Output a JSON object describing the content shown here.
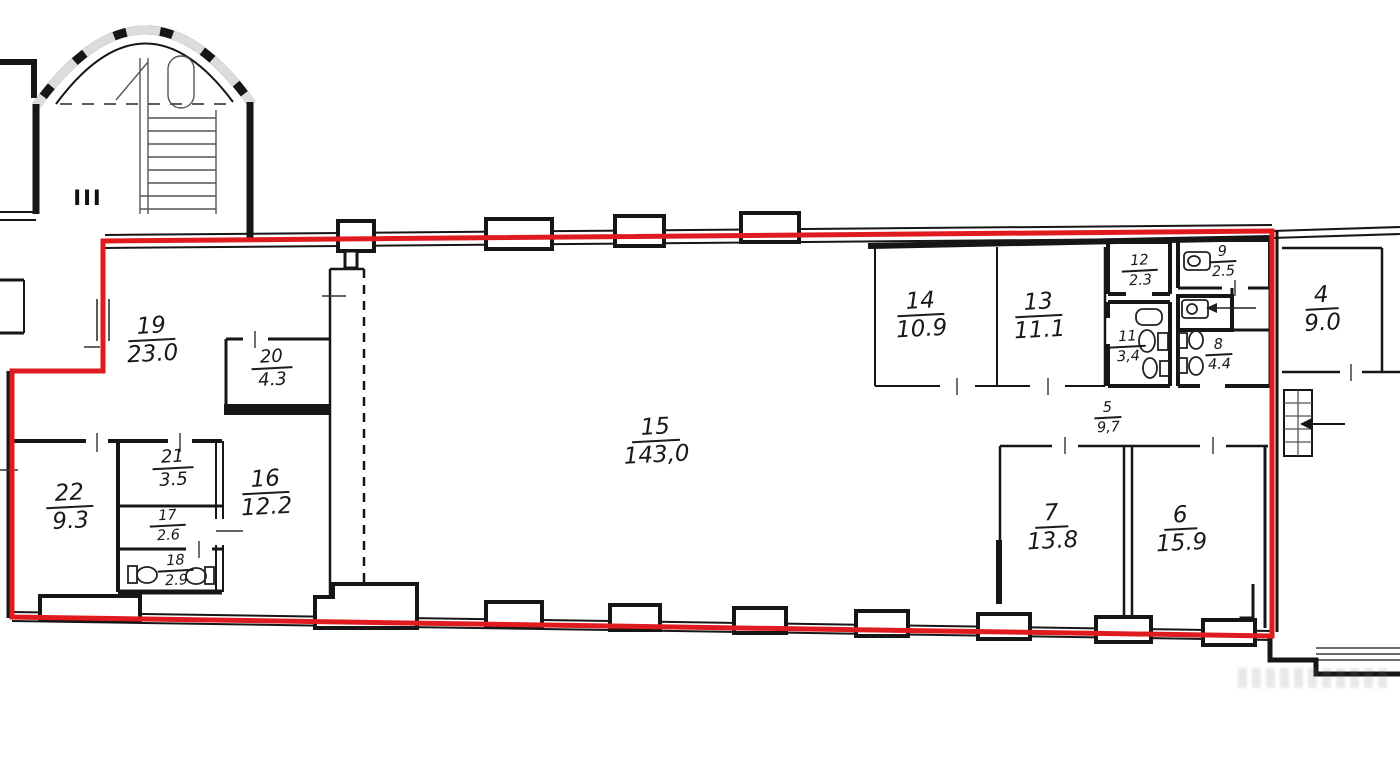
{
  "plan": {
    "stair_label": "III",
    "boundary_color": "#e01b20",
    "wall_color": "#161616",
    "rooms": [
      {
        "number": "19",
        "area": "23.0"
      },
      {
        "number": "20",
        "area": "4.3"
      },
      {
        "number": "21",
        "area": "3.5"
      },
      {
        "number": "22",
        "area": "9.3"
      },
      {
        "number": "17",
        "area": "2.6"
      },
      {
        "number": "18",
        "area": "2.9"
      },
      {
        "number": "16",
        "area": "12.2"
      },
      {
        "number": "15",
        "area": "143,0"
      },
      {
        "number": "14",
        "area": "10.9"
      },
      {
        "number": "13",
        "area": "11.1"
      },
      {
        "number": "12",
        "area": "2.3"
      },
      {
        "number": "9",
        "area": "2.5"
      },
      {
        "number": "11",
        "area": "3,4"
      },
      {
        "number": "8",
        "area": "4.4"
      },
      {
        "number": "5",
        "area": "9,7"
      },
      {
        "number": "7",
        "area": "13.8"
      },
      {
        "number": "6",
        "area": "15.9"
      },
      {
        "number": "4",
        "area": "9.0"
      }
    ]
  }
}
